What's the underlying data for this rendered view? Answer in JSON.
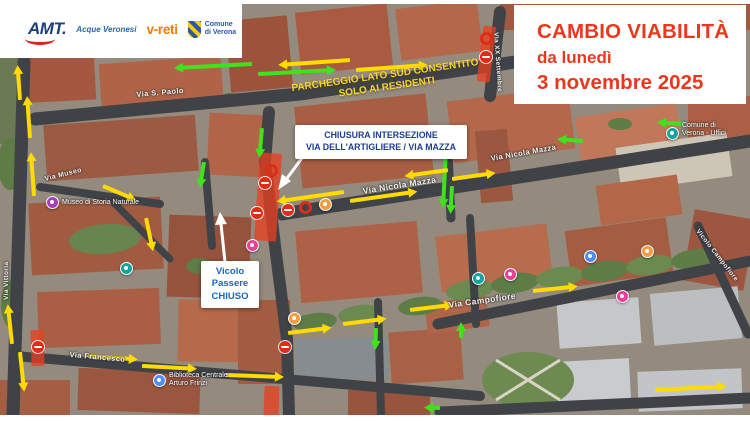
{
  "logos": {
    "amt": "AMT.",
    "acque": "Acque Veronesi",
    "vreti": "v-reti",
    "comune_line1": "Comune",
    "comune_line2": "di Verona"
  },
  "title": {
    "line1": "CAMBIO VIABILITÀ",
    "line2": "da lunedì",
    "line3": "3 novembre 2025"
  },
  "notices": {
    "parking": {
      "line1": "PARCHEGGIO LATO SUD CONSENTITO",
      "line2": "SOLO AI RESIDENTI"
    },
    "closure": {
      "line1": "CHIUSURA INTERSEZIONE",
      "line2": "VIA DELL'ARTIGLIERE / VIA MAZZA"
    },
    "vicolo": {
      "line1": "Vicolo",
      "line2": "Passere",
      "line3": "CHIUSO"
    }
  },
  "map": {
    "street_labels": [
      {
        "text": "Via S. Paolo"
      },
      {
        "text": "Via Museo"
      },
      {
        "text": "Via Nicola Mazza"
      },
      {
        "text": "Via Nicola Mazza"
      },
      {
        "text": "Via XX Settembre"
      },
      {
        "text": "Via Campofiore"
      },
      {
        "text": "Via Francesco"
      },
      {
        "text": "Vicolo Campofiore"
      },
      {
        "text": "Via Vittoria"
      }
    ],
    "poi_labels": [
      {
        "line1": "Museo di Storia Naturale",
        "line2": ""
      },
      {
        "line1": "Biblioteca Centrale",
        "line2": "Arturo Frinzi"
      },
      {
        "line1": "Comune di",
        "line2": "Verona - Uffici"
      }
    ],
    "icons": {
      "no_entry_sign": "red circle with white bar",
      "closure_ring": "red ring marker",
      "poi_marker": "colored dot with white center",
      "direction_arrow_green": "allowed direction",
      "direction_arrow_yellow": "changed direction"
    },
    "colors": {
      "arrow_green": "#3ee31c",
      "arrow_yellow": "#ffdb00",
      "closure_red": "#de2c17",
      "notice_yellow": "#f7d531",
      "title_red": "#e8391d"
    }
  }
}
